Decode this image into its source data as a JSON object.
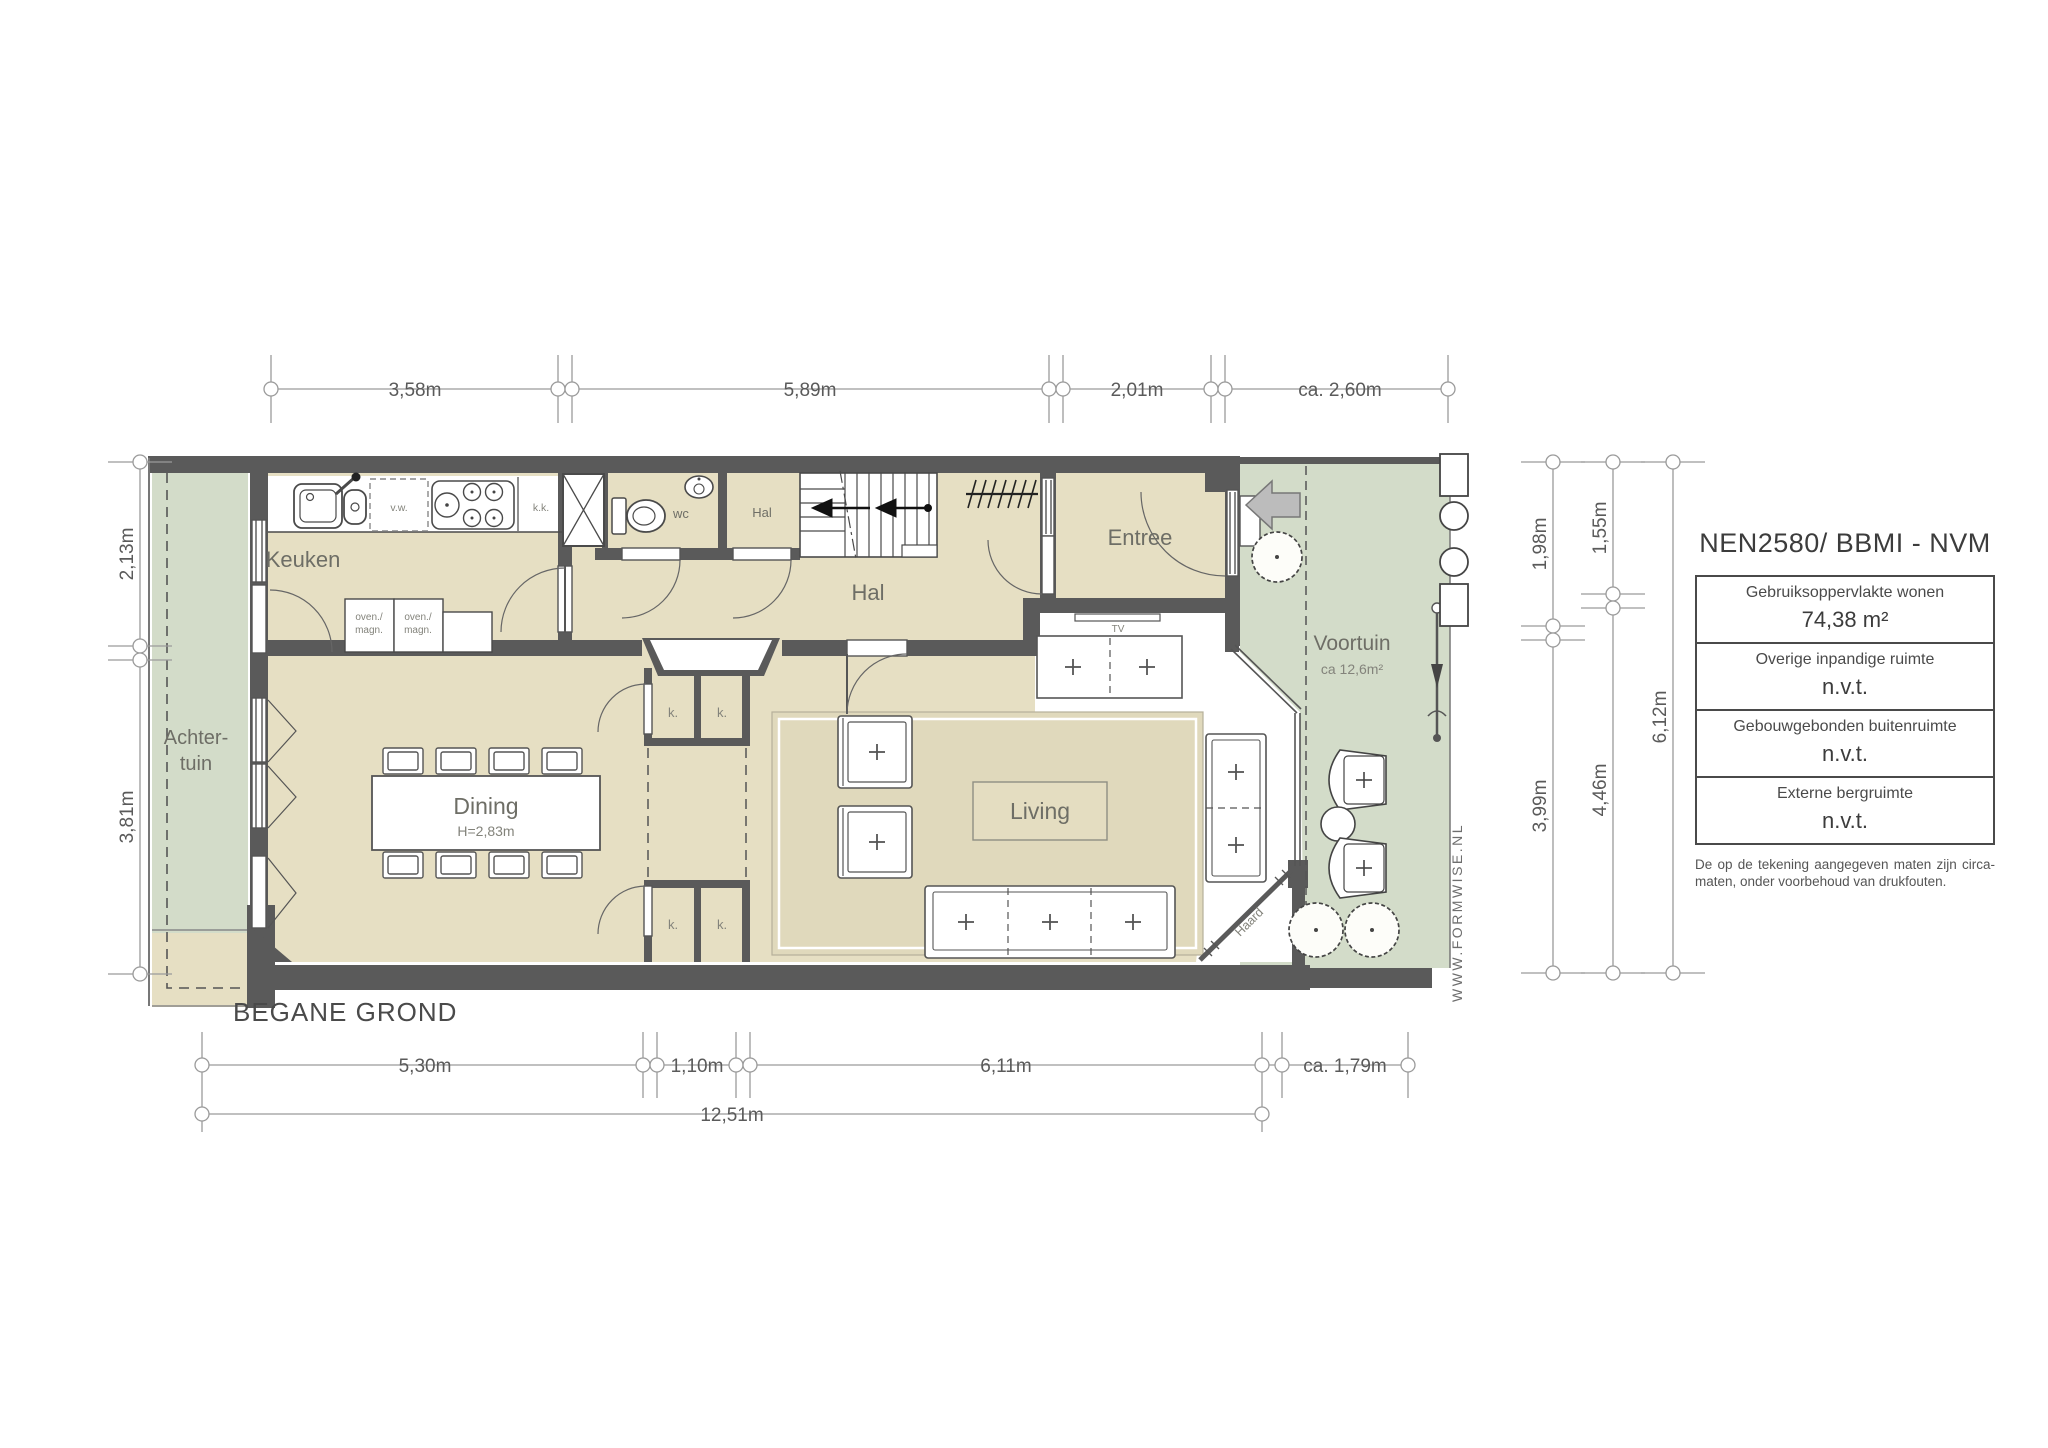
{
  "title": "BEGANE GROND",
  "watermark": "WWW.FORMWISE.NL",
  "colors": {
    "wall": "#5a5a5a",
    "floor": "#e6dfc3",
    "garden": "#d3dcc9",
    "line": "#9a9a9a"
  },
  "rooms": {
    "keuken": "Keuken",
    "hal": "Hal",
    "hal_klein": "Hal",
    "wc": "wc",
    "entree": "Entree",
    "dining": {
      "label": "Dining",
      "height": "H=2,83m"
    },
    "living": "Living",
    "voortuin": {
      "label": "Voortuin",
      "area": "ca 12,6m²"
    },
    "achtertuin": {
      "line1": "Achter-",
      "line2": "tuin"
    }
  },
  "fixtures": {
    "vw": "v.w.",
    "kk": "k.k.",
    "oven": {
      "line1": "oven./",
      "line2": "magn."
    },
    "tv": "TV",
    "haard": "Haard",
    "kast": "k."
  },
  "dimensions": {
    "top": [
      "3,58m",
      "5,89m",
      "2,01m",
      "ca. 2,60m"
    ],
    "bottom": [
      "5,30m",
      "1,10m",
      "6,11m",
      "ca. 1,79m"
    ],
    "bottom_total": "12,51m",
    "left": [
      "2,13m",
      "3,81m"
    ],
    "right": [
      "1,98m",
      "3,99m",
      "1,55m",
      "4,46m",
      "6,12m"
    ]
  },
  "legend": {
    "title": "NEN2580/ BBMI - NVM",
    "rows": [
      {
        "label": "Gebruiksoppervlakte wonen",
        "value": "74,38 m²"
      },
      {
        "label": "Overige inpandige ruimte",
        "value": "n.v.t."
      },
      {
        "label": "Gebouwgebonden buitenruimte",
        "value": "n.v.t."
      },
      {
        "label": "Externe bergruimte",
        "value": "n.v.t."
      }
    ],
    "disclaimer": "De op de tekening aangegeven maten zijn circa-maten, onder voorbehoud van drukfouten."
  }
}
